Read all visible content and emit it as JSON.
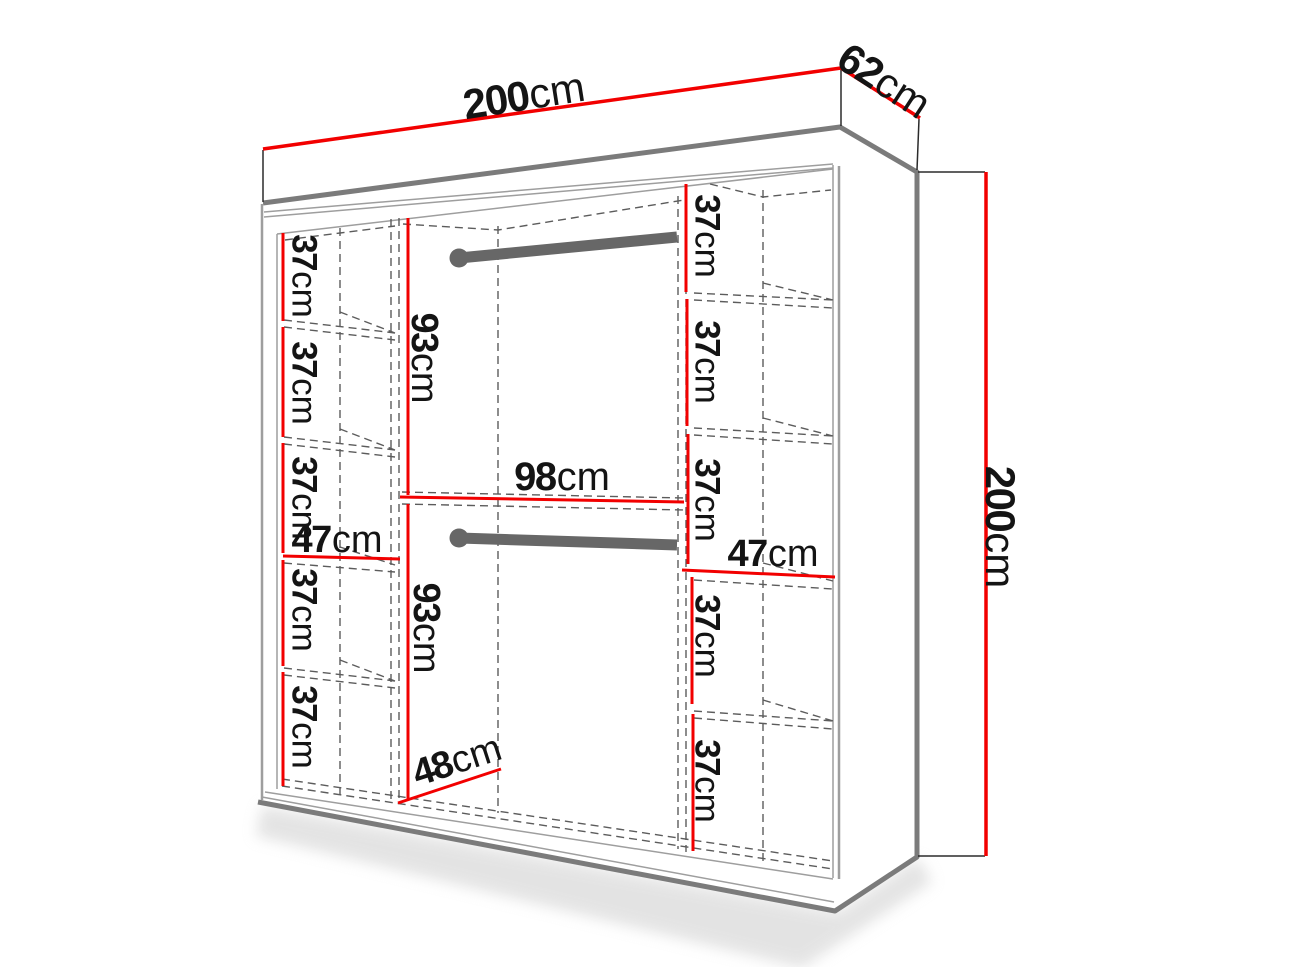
{
  "diagram": {
    "type": "wardrobe-dimension-diagram",
    "colors": {
      "dimension_red": "#f20000",
      "edge_gray": "#7b7b7b",
      "thin_gray": "#9e9e9e",
      "dash_gray": "#5c5c5c",
      "rail_gray": "#676767",
      "extension_black": "#2b2b2b",
      "text_black": "#141414"
    },
    "overall": {
      "width": {
        "num": "200",
        "unit": "cm"
      },
      "depth": {
        "num": "62",
        "unit": "cm"
      },
      "height": {
        "num": "200",
        "unit": "cm"
      }
    },
    "interior": {
      "hanging_upper": {
        "num": "93",
        "unit": "cm"
      },
      "hanging_lower": {
        "num": "93",
        "unit": "cm"
      },
      "middle_width": {
        "num": "98",
        "unit": "cm"
      },
      "left_column_width": {
        "num": "47",
        "unit": "cm"
      },
      "right_column_width": {
        "num": "47",
        "unit": "cm"
      },
      "column_depth": {
        "num": "48",
        "unit": "cm"
      },
      "left_shelf_spacings": [
        {
          "num": "37",
          "unit": "cm"
        },
        {
          "num": "37",
          "unit": "cm"
        },
        {
          "num": "37",
          "unit": "cm"
        },
        {
          "num": "37",
          "unit": "cm"
        },
        {
          "num": "37",
          "unit": "cm"
        }
      ],
      "right_shelf_spacings": [
        {
          "num": "37",
          "unit": "cm"
        },
        {
          "num": "37",
          "unit": "cm"
        },
        {
          "num": "37",
          "unit": "cm"
        },
        {
          "num": "37",
          "unit": "cm"
        },
        {
          "num": "37",
          "unit": "cm"
        }
      ]
    }
  }
}
